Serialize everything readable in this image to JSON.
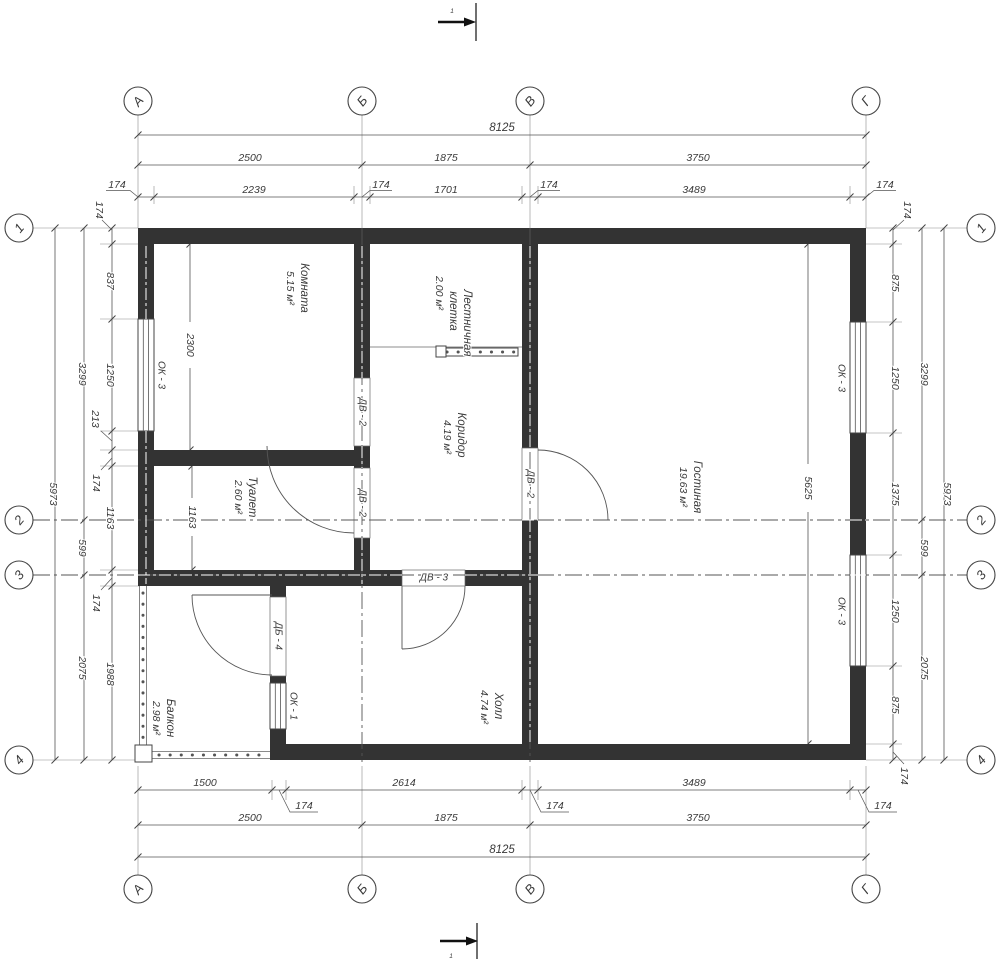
{
  "axes": {
    "top": [
      "А",
      "Б",
      "В",
      "Г"
    ],
    "bottom": [
      "А",
      "Б",
      "В",
      "Г"
    ],
    "left": [
      "1",
      "2",
      "3",
      "4"
    ],
    "right": [
      "1",
      "2",
      "3",
      "4"
    ]
  },
  "dims": {
    "top": {
      "total": "8125",
      "spans": [
        "2500",
        "1875",
        "3750"
      ],
      "details": [
        "174",
        "2239",
        "174",
        "1701",
        "174",
        "3489",
        "174"
      ]
    },
    "bottom": {
      "total": "8125",
      "spans": [
        "2500",
        "1875",
        "3750"
      ],
      "details": [
        "1500",
        "174",
        "2614",
        "174",
        "3489",
        "174"
      ]
    },
    "left": {
      "total": "5973",
      "spans": [
        "3299",
        "599",
        "2075"
      ],
      "details": [
        "174",
        "837",
        "1250",
        "213",
        "174",
        "1163",
        "174",
        "1988"
      ]
    },
    "right": {
      "total": "5973",
      "spans": [
        "3299",
        "599",
        "2075"
      ],
      "details": [
        "174",
        "875",
        "1250",
        "1375",
        "1250",
        "875",
        "174"
      ]
    },
    "interior": {
      "komnata": "2300",
      "toilet": "1163",
      "living": "5625"
    }
  },
  "rooms": [
    {
      "name": "Комната",
      "area": "5.15 м²"
    },
    {
      "name": "Лестничная",
      "name2": "клетка",
      "area": "2.00 м²"
    },
    {
      "name": "Коридор",
      "area": "4.19 м²"
    },
    {
      "name": "Туалет",
      "area": "2.60 м²"
    },
    {
      "name": "Гостиная",
      "area": "19.63 м²"
    },
    {
      "name": "Холл",
      "area": "4.74 м²"
    },
    {
      "name": "Балкон",
      "area": "2.98 м²"
    }
  ],
  "openings": {
    "ok3": "ОК - 3",
    "ok1": "ОК - 1",
    "dv2": "ДВ - 2",
    "dv3": "ДВ - 3",
    "db4": "ДБ - 4"
  },
  "section": {
    "label": "1"
  },
  "colors": {
    "wall": "#333333",
    "line": "#555555",
    "text": "#3a3a3a",
    "background": "#ffffff"
  }
}
